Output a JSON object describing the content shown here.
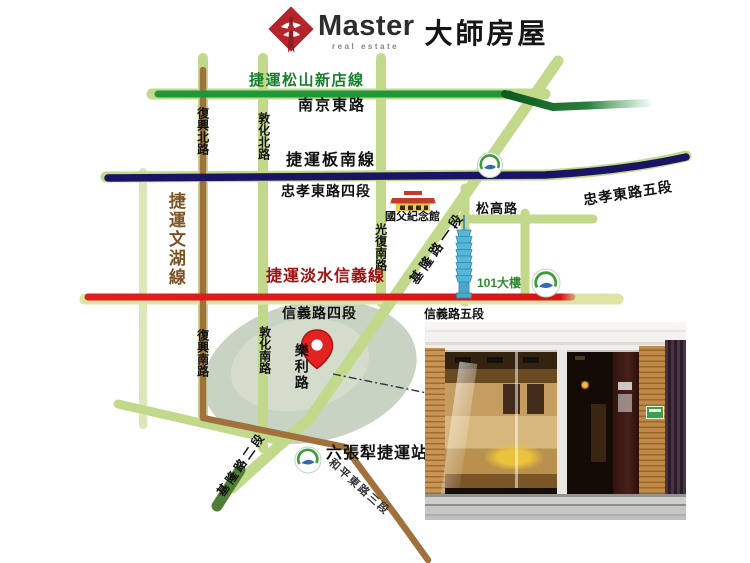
{
  "logo": {
    "brand": "Master",
    "tagline": "real estate",
    "brand_cjk": "大師房屋",
    "accent_color": "#b5242a"
  },
  "map": {
    "mrt_lines": {
      "songshan_xindian": {
        "label": "捷運松山新店線",
        "color": "#1f9638"
      },
      "bannan": {
        "label": "捷運板南線",
        "color": "#1b1464"
      },
      "tamsui_xinyi": {
        "label": "捷運淡水信義線",
        "color": "#e21d1d"
      },
      "wenhu": {
        "label": "捷運文湖線",
        "color": "#a0713c"
      }
    },
    "roads": {
      "nanjing_e": "南京東路",
      "fuxing_n": "復興北路",
      "dunhua_n": "敦化北路",
      "zhongxiao_e4": "忠孝東路四段",
      "zhongxiao_e5": "忠孝東路五段",
      "guangfu_s": "光復南路",
      "keelung_1": "基隆路一段",
      "songgao": "松高路",
      "xinyi_4": "信義路四段",
      "xinyi_5": "信義路五段",
      "fuxing_s": "復興南路",
      "dunhua_s": "敦化南路",
      "leli": "樂利路",
      "keelung_2": "基隆路二段",
      "heping_e3": "和平東路三段"
    },
    "landmarks": {
      "memorial_hall": "國父紀念館",
      "tower_101": "101大樓",
      "liuzhangli_station": "六張犁捷運站"
    },
    "road_color": "#c2d98c",
    "location_pin_color": "#e32222"
  }
}
